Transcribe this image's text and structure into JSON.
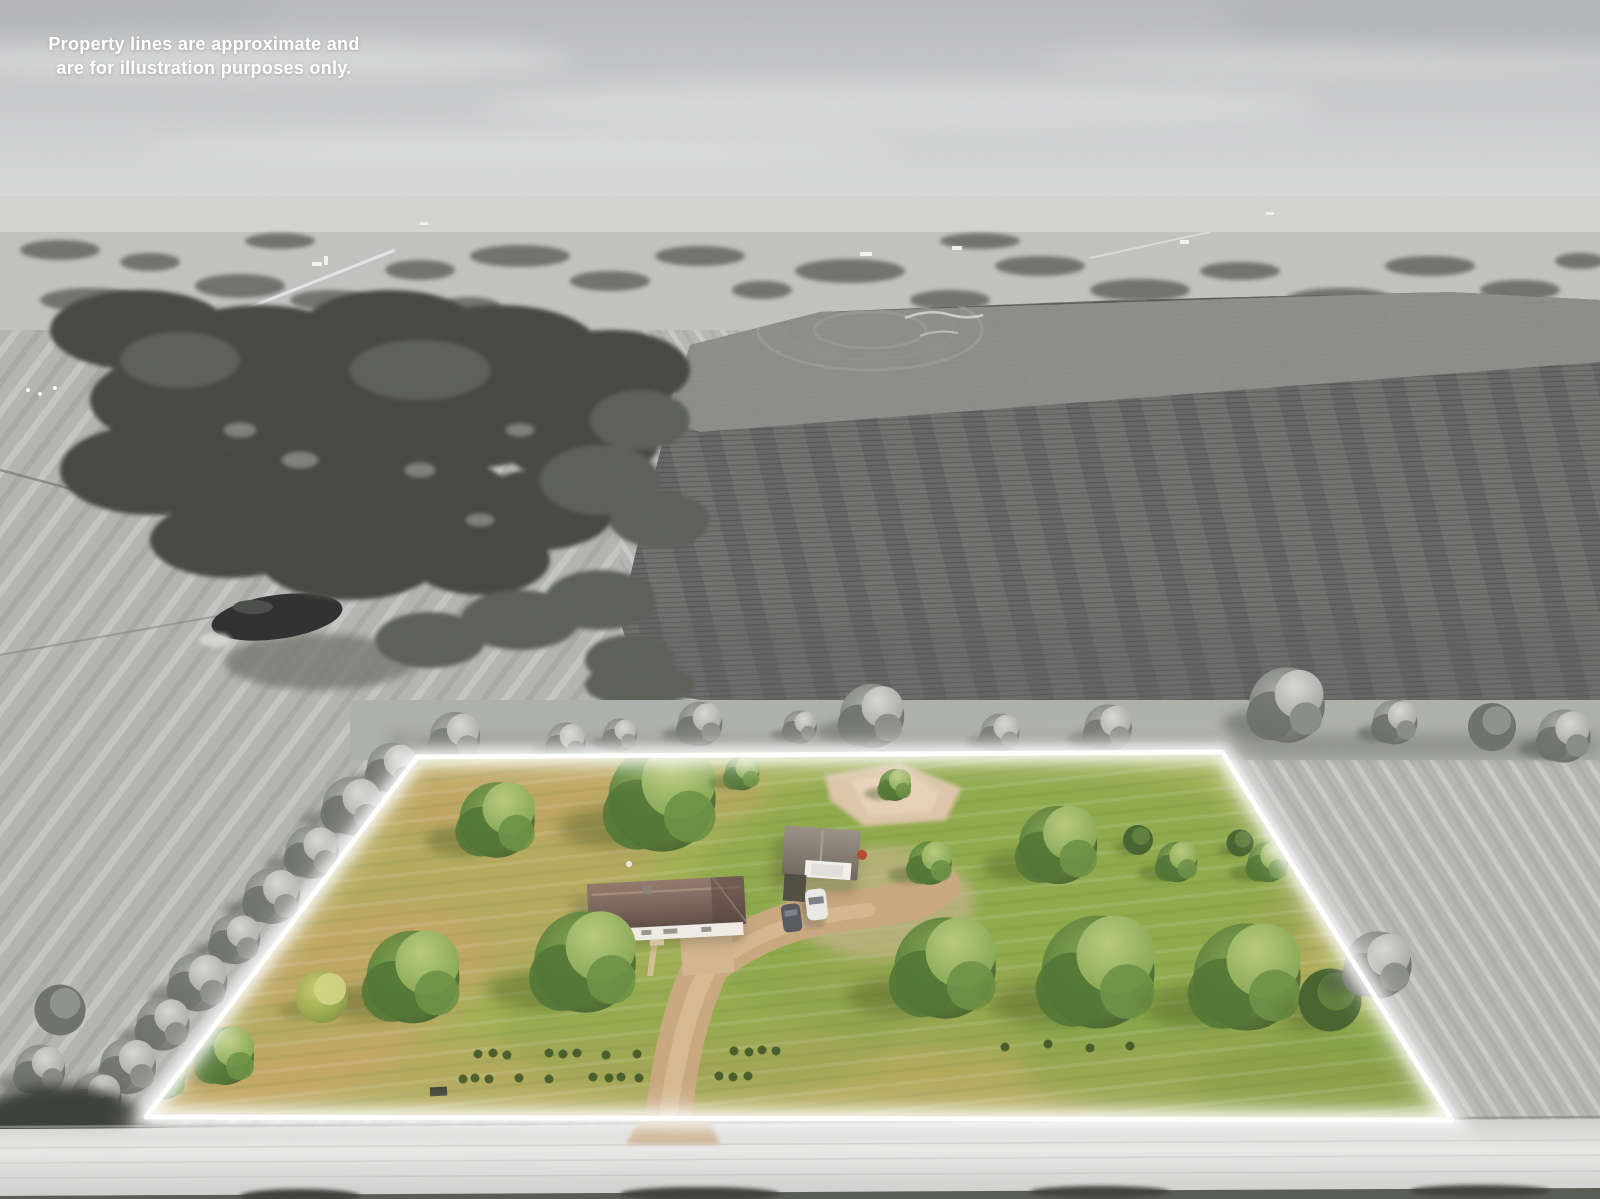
{
  "overlay": {
    "disclaimer_line1": "Property lines are approximate and",
    "disclaimer_line2": "are for illustration purposes only."
  },
  "scene": {
    "style": "aerial drone real-estate photo; surroundings desaturated to grayscale; highlighted parcel shown in full color with white outline",
    "colors": {
      "boundary": "#ffffff",
      "lawn": "#a3b155",
      "lawn_dry": "#c8a466",
      "driveway": "#c9a87e",
      "dirt_patch": "#ddc5a8",
      "house_roof": "#6f5a50",
      "house_walls": "#efece5",
      "garage_roof": "#8d8277",
      "tree_green": "#5e8139",
      "sky": "#cdcfd0",
      "plowed_field": "#717270",
      "road": "#dededd"
    },
    "objects": {
      "parcel": "rectangular lawn parcel outlined in white",
      "house": "single-story house, dark brown roof, white walls",
      "garage": "detached garage with gray gable roof",
      "vehicles": [
        "white car",
        "dark gray car"
      ],
      "driveway": "tan gravel driveway from road to house and garage",
      "pond": "small dark pond among gray fields at left",
      "road": "light gray road along bottom edge"
    }
  }
}
